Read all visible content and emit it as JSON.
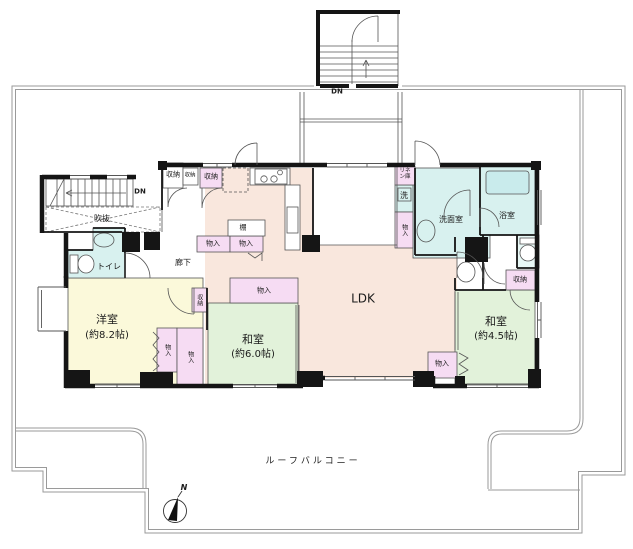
{
  "floorplan": {
    "rooms": [
      {
        "id": "ldk",
        "label": "LDK"
      },
      {
        "id": "yoshitsu",
        "label": "洋室",
        "size": "(約8.2帖)"
      },
      {
        "id": "washitsu6",
        "label": "和室",
        "size": "(約6.0帖)"
      },
      {
        "id": "washitsu45",
        "label": "和室",
        "size": "(約4.5帖)"
      },
      {
        "id": "toilet",
        "label": "トイレ"
      },
      {
        "id": "senmenshitsu",
        "label": "洗面室"
      },
      {
        "id": "yokushitsu",
        "label": "浴室"
      },
      {
        "id": "rouka",
        "label": "廊下"
      },
      {
        "id": "fukinuke",
        "label": "吹抜"
      },
      {
        "id": "linen",
        "label": "リネン庫"
      },
      {
        "id": "washer",
        "label": "洗"
      },
      {
        "id": "tana",
        "label": "棚"
      }
    ],
    "storage": {
      "monoire": "物入",
      "shuno": "収納"
    },
    "stairs": {
      "down_label": "DN"
    },
    "balcony": {
      "label": "ルーフバルコニー"
    },
    "compass": {
      "north_label": "N"
    },
    "colors": {
      "ldk_fill": "#f9e7dd",
      "tatami_fill": "#e2f2da",
      "western_fill": "#fbf9da",
      "sanitary_fill": "#d8f1ef",
      "storage_fill": "#f6dcf3",
      "wall": "#151515",
      "balcony_line": "#9a9a9a"
    }
  }
}
